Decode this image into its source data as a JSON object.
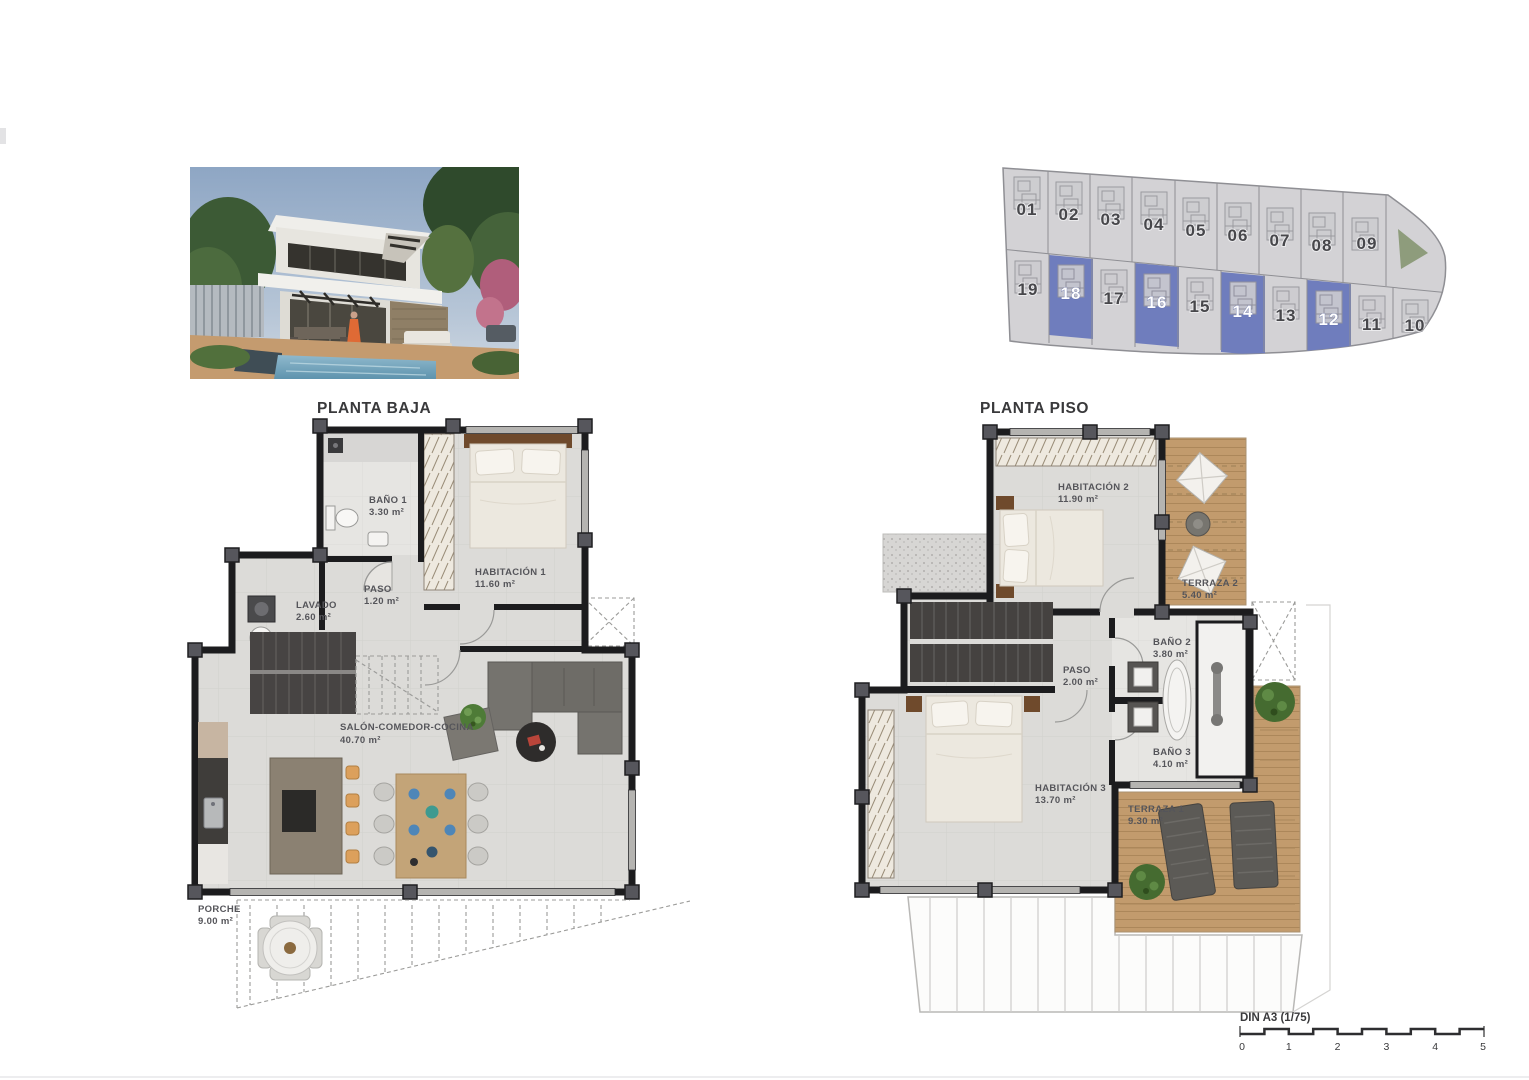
{
  "planta_baja": {
    "title": "PLANTA BAJA",
    "rooms": [
      {
        "name": "BAÑO 1",
        "area": "3.30 m²"
      },
      {
        "name": "HABITACIÓN 1",
        "area": "11.60 m²"
      },
      {
        "name": "PASO",
        "area": "1.20 m²"
      },
      {
        "name": "LAVADO",
        "area": "2.60 m²"
      },
      {
        "name": "SALÓN-COMEDOR-COCINA",
        "area": "40.70 m²"
      },
      {
        "name": "PORCHE",
        "area": "9.00 m²"
      }
    ]
  },
  "planta_piso": {
    "title": "PLANTA PISO",
    "rooms": [
      {
        "name": "HABITACIÓN 2",
        "area": "11.90 m²"
      },
      {
        "name": "TERRAZA 2",
        "area": "5.40 m²"
      },
      {
        "name": "BAÑO 2",
        "area": "3.80 m²"
      },
      {
        "name": "PASO",
        "area": "2.00 m²"
      },
      {
        "name": "BAÑO 3",
        "area": "4.10 m²"
      },
      {
        "name": "HABITACIÓN 3",
        "area": "13.70 m²"
      },
      {
        "name": "TERRAZA 1",
        "area": "9.30 m²"
      }
    ]
  },
  "site_plan": {
    "highlight_color": "#6f7dbd",
    "plots": [
      {
        "num": "01",
        "fill": "#d3d2d5",
        "num_color": "#47474b"
      },
      {
        "num": "02",
        "fill": "#d3d2d5",
        "num_color": "#47474b"
      },
      {
        "num": "03",
        "fill": "#d3d2d5",
        "num_color": "#47474b"
      },
      {
        "num": "04",
        "fill": "#d3d2d5",
        "num_color": "#47474b"
      },
      {
        "num": "05",
        "fill": "#d3d2d5",
        "num_color": "#47474b"
      },
      {
        "num": "06",
        "fill": "#d3d2d5",
        "num_color": "#47474b"
      },
      {
        "num": "07",
        "fill": "#d3d2d5",
        "num_color": "#47474b"
      },
      {
        "num": "08",
        "fill": "#d3d2d5",
        "num_color": "#47474b"
      },
      {
        "num": "09",
        "fill": "#d3d2d5",
        "num_color": "#47474b"
      },
      {
        "num": "19",
        "fill": "#d3d2d5",
        "num_color": "#47474b"
      },
      {
        "num": "18",
        "fill": "#6f7dbd",
        "num_color": "#ffffff"
      },
      {
        "num": "17",
        "fill": "#d3d2d5",
        "num_color": "#47474b"
      },
      {
        "num": "16",
        "fill": "#6f7dbd",
        "num_color": "#ffffff"
      },
      {
        "num": "15",
        "fill": "#d3d2d5",
        "num_color": "#47474b"
      },
      {
        "num": "14",
        "fill": "#6f7dbd",
        "num_color": "#ffffff"
      },
      {
        "num": "13",
        "fill": "#d3d2d5",
        "num_color": "#47474b"
      },
      {
        "num": "12",
        "fill": "#6f7dbd",
        "num_color": "#ffffff"
      },
      {
        "num": "11",
        "fill": "#d3d2d5",
        "num_color": "#47474b"
      },
      {
        "num": "10",
        "fill": "#d3d2d5",
        "num_color": "#47474b"
      }
    ]
  },
  "scale_bar": {
    "label": "DIN A3 (1/75)",
    "ticks": [
      "0",
      "1",
      "2",
      "3",
      "4",
      "5"
    ]
  }
}
